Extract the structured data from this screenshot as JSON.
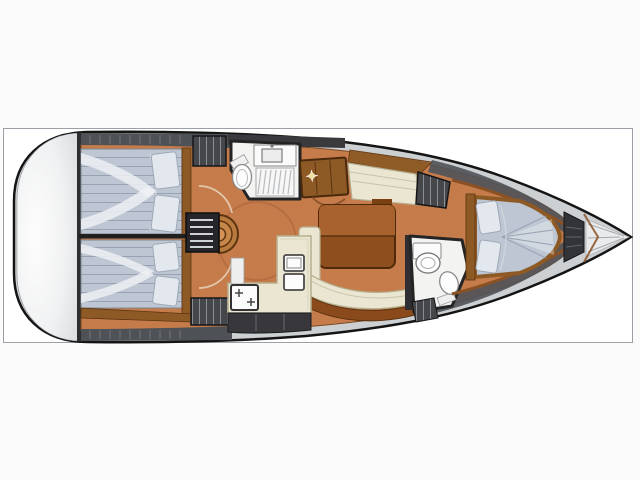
{
  "diagram": {
    "type": "floor-plan",
    "subject": "sailing-yacht-interior-layout",
    "orientation": "bow-right",
    "rooms": [
      "transom-platform",
      "aft-cabin-port",
      "aft-cabin-starboard",
      "companionway-steps",
      "aft-head",
      "chart-table",
      "saloon-table",
      "saloon-settee",
      "galley",
      "forward-head",
      "forward-cabin-v-berth",
      "anchor-locker",
      "bow"
    ]
  },
  "markers": {
    "compass_star": "✦"
  },
  "palette": {
    "page_bg": "#fbfbfb",
    "frame_border": "#9aa0a6",
    "hull_outline": "#141414",
    "deck_gray": "#cdd0d2",
    "deck_dark": "#4e5156",
    "transom_light": "#fdfdfd",
    "transom_shade": "#dcdee0",
    "floor": "#c57c4a",
    "floor_line": "#7c4a22",
    "wood": "#8d5a26",
    "wood_dark": "#5d3410",
    "wall_dark": "#2e2e31",
    "locker_dark": "#46474b",
    "hatch_line": "#9aa0a8",
    "cream": "#eae6d2",
    "cream_line": "#b5ae8f",
    "cream_seam": "#c9c3a6",
    "mattress": "#bdc6d2",
    "mattress_line": "#97a2b2",
    "pillow": "#e3e8ee",
    "pillow_line": "#9fa9b6",
    "fixture_white": "#f3f3f2",
    "fixture_line": "#8a8a8a",
    "table_top": "#a8622e",
    "table_bottom": "#8f4e1d",
    "table_outline": "#4f2a0a",
    "star_gold": "#f0dda0",
    "stair_wood": "#b97a3e",
    "cabinet_dark": "#38383c"
  }
}
